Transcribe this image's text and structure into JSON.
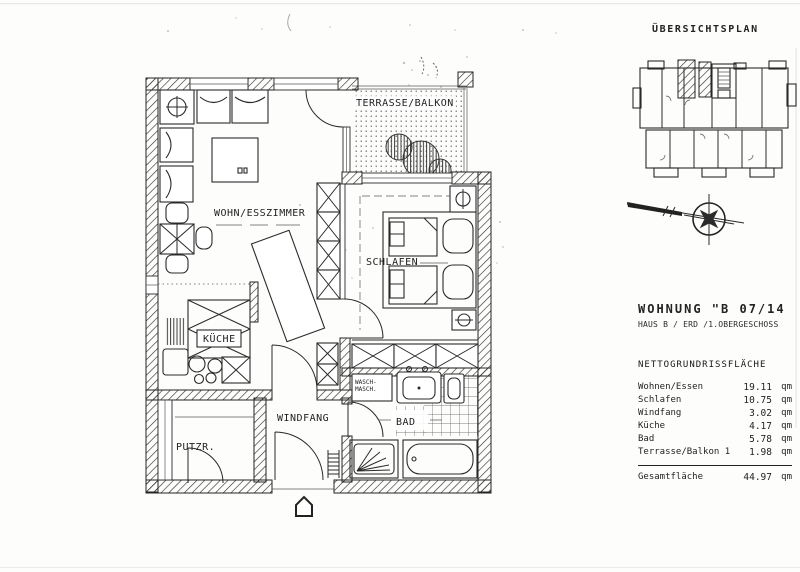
{
  "overview": {
    "title": "ÜBERSICHTSPLAN"
  },
  "floorplan": {
    "labels": {
      "living": "WOHN/ESSZIMMER",
      "terrace": "TERRASSE/BALKON",
      "bedroom": "SCHLAFEN",
      "kitchen": "KÜCHE",
      "utility": "PUTZR.",
      "vestibule": "WINDFANG",
      "bath": "BAD",
      "washer_line1": "WASCH-",
      "washer_line2": "MASCH."
    }
  },
  "apartment": {
    "title": "WOHNUNG \"B 07/14",
    "subtitle": "HAUS B / ERD /1.OBERGESCHOSS",
    "area_table": {
      "heading": "NETTOGRUNDRISSFLÄCHE",
      "rows": [
        {
          "label": "Wohnen/Essen",
          "value": "19.11",
          "unit": "qm"
        },
        {
          "label": "Schlafen",
          "value": "10.75",
          "unit": "qm"
        },
        {
          "label": "Windfang",
          "value": "3.02",
          "unit": "qm"
        },
        {
          "label": "Küche",
          "value": "4.17",
          "unit": "qm"
        },
        {
          "label": "Bad",
          "value": "5.78",
          "unit": "qm"
        },
        {
          "label": "Terrasse/Balkon 1",
          "value": "1.98",
          "unit": "qm"
        }
      ],
      "total": {
        "label": "Gesamtfläche",
        "value": "44.97",
        "unit": "qm"
      }
    }
  },
  "colors": {
    "ink": "#232323",
    "paper": "#fdfdfb",
    "hatch": "#2d2d2d"
  }
}
